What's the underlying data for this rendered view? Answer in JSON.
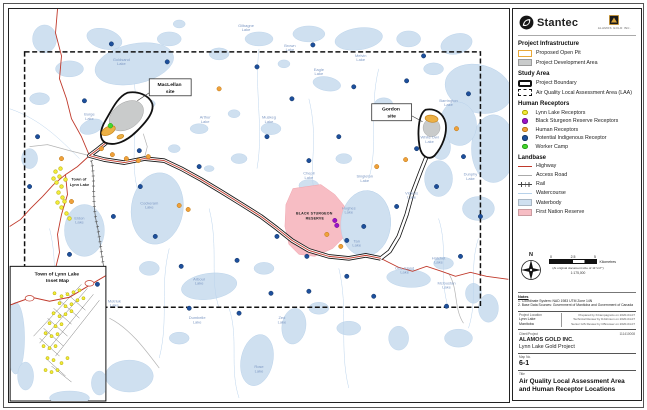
{
  "branding": {
    "stantec": "Stantec",
    "client_logo_caption": "Alamos Gold Inc."
  },
  "legend": {
    "sections": [
      {
        "title": "Project Infrastructure",
        "items": [
          {
            "label": "Proposed Open Pit",
            "swatch": "open-pit"
          },
          {
            "label": "Project Development Area",
            "swatch": "dev-area"
          }
        ]
      },
      {
        "title": "Study Area",
        "items": [
          {
            "label": "Project Boundary",
            "swatch": "project-boundary"
          },
          {
            "label": "Air Quality Local Assessment Area (LAA)",
            "swatch": "laa"
          }
        ]
      },
      {
        "title": "Human Receptors",
        "items": [
          {
            "label": "Lynn Lake Receptors",
            "swatch": "dot",
            "color": "#f1ec3a",
            "stroke": "#b5a900"
          },
          {
            "label": "Black Sturgeon Reserve Receptors",
            "swatch": "dot",
            "color": "#9b13c8",
            "stroke": "#6d0d8e"
          },
          {
            "label": "Human Receptors",
            "swatch": "dot",
            "color": "#f0a13a",
            "stroke": "#b97413"
          },
          {
            "label": "Potential Indigenous Receptor",
            "swatch": "dot",
            "color": "#1d4f9c",
            "stroke": "#123463"
          },
          {
            "label": "Worker Camp",
            "swatch": "dot",
            "color": "#45d62e",
            "stroke": "#249e15"
          }
        ]
      },
      {
        "title": "Landbase",
        "items": [
          {
            "label": "Highway",
            "swatch": "line",
            "color": "#c0392b"
          },
          {
            "label": "Access Road",
            "swatch": "line",
            "color": "#aaaaaa"
          },
          {
            "label": "Rail",
            "swatch": "rail"
          },
          {
            "label": "Watercourse",
            "swatch": "watercourse",
            "color": "#b8d2ea"
          },
          {
            "label": "Waterbody",
            "swatch": "fill",
            "color": "#cfe0f0"
          },
          {
            "label": "First Nation Reserve",
            "swatch": "fill",
            "color": "#f7bdc4"
          }
        ]
      }
    ]
  },
  "compass": {
    "label": "N"
  },
  "scalebar": {
    "ticks": [
      "0",
      "2.5",
      "5"
    ],
    "unit": "Kilometres",
    "note": "(At original document size of 11\"x17\")",
    "ratio": "1:175,000"
  },
  "notes": {
    "heading": "Notes",
    "lines": [
      "1. Coordinate System: NAD 1983 UTM Zone 14N",
      "2. Base Data Sources: Government of Manitoba and Government of Canada"
    ]
  },
  "title_block": {
    "project_location_label": "Project Location",
    "project_location": [
      "Lynn Lake",
      "Manitoba"
    ],
    "credits": [
      "Prepared by KCampagnolo on 2020-04-07",
      "Technical Review by DJohnson on 2020-04-07",
      "Senior GIS Review by CBrouwer on 2020-04-07"
    ],
    "client_project_label": "Client/Project",
    "project_number": "111410008",
    "client": "ALAMOS GOLD INC.",
    "project": "Lynn Lake Gold Project",
    "map_no_label": "Map No.",
    "map_no": "6-1",
    "title_label": "Title",
    "title": "Air Quality Local Assessment Area and Human Receptor Locations"
  },
  "map": {
    "labels": {
      "maclellan": {
        "line1": "MacLellan",
        "line2": "site"
      },
      "gordon": {
        "line1": "Gordon",
        "line2": "site"
      },
      "town": {
        "line1": "Town of",
        "line2": "Lynn Lake"
      },
      "reserve": {
        "line1": "BLACK STURGEON",
        "line2": "RESERVE"
      },
      "inset_title": {
        "line1": "Town of Lynn Lake",
        "line2": "Inset Map"
      }
    },
    "lakes": [
      {
        "name": "Goldsand Lake",
        "x": 112,
        "y": 52
      },
      {
        "name": "Gilbagne Lake",
        "x": 237,
        "y": 18
      },
      {
        "name": "Brown Lake",
        "x": 281,
        "y": 38
      },
      {
        "name": "Eagle Lake",
        "x": 310,
        "y": 62
      },
      {
        "name": "Melvin Lake",
        "x": 352,
        "y": 48
      },
      {
        "name": "Burge Lake",
        "x": 80,
        "y": 107
      },
      {
        "name": "Arthur Lake",
        "x": 196,
        "y": 110
      },
      {
        "name": "Muskeg Lake",
        "x": 260,
        "y": 110
      },
      {
        "name": "Barrington Lake",
        "x": 440,
        "y": 93
      },
      {
        "name": "White Owl Lake",
        "x": 421,
        "y": 130
      },
      {
        "name": "Dunphy Lake",
        "x": 462,
        "y": 167
      },
      {
        "name": "Singleton Lake",
        "x": 356,
        "y": 169
      },
      {
        "name": "Vickers Lake",
        "x": 403,
        "y": 186
      },
      {
        "name": "Cockeram Lake",
        "x": 140,
        "y": 196
      },
      {
        "name": "Eldon Lake",
        "x": 70,
        "y": 211
      },
      {
        "name": "Chepil Lake",
        "x": 300,
        "y": 166
      },
      {
        "name": "Hughes Lake",
        "x": 340,
        "y": 201
      },
      {
        "name": "Tan Lake",
        "x": 348,
        "y": 234
      },
      {
        "name": "One Island Lake",
        "x": 396,
        "y": 261
      },
      {
        "name": "Hatchet Lake",
        "x": 430,
        "y": 251
      },
      {
        "name": "McGustan Lake",
        "x": 438,
        "y": 276
      },
      {
        "name": "Arbour Lake",
        "x": 190,
        "y": 272
      },
      {
        "name": "Motriuk Lake",
        "x": 105,
        "y": 294
      },
      {
        "name": "Dumbelle Lake",
        "x": 188,
        "y": 311
      },
      {
        "name": "Zed Lake",
        "x": 273,
        "y": 311
      },
      {
        "name": "Rose Lake",
        "x": 250,
        "y": 360
      }
    ],
    "receptors": [
      {
        "name": "lynn-lake-receptor",
        "color": "#f1ec3a",
        "stroke": "#b5a900",
        "r": 1.9,
        "points": [
          [
            46,
            163
          ],
          [
            50,
            168
          ],
          [
            47,
            174
          ],
          [
            52,
            178
          ],
          [
            49,
            184
          ],
          [
            53,
            189
          ],
          [
            48,
            194
          ],
          [
            52,
            199
          ],
          [
            56,
            171
          ],
          [
            55,
            193
          ],
          [
            44,
            170
          ],
          [
            51,
            160
          ],
          [
            57,
            205
          ],
          [
            60,
            210
          ]
        ]
      },
      {
        "name": "black-sturgeon-receptor",
        "color": "#9b13c8",
        "stroke": "#6d0d8e",
        "r": 2.2,
        "points": [
          [
            326,
            212
          ],
          [
            328,
            217
          ]
        ]
      },
      {
        "name": "human-receptor",
        "color": "#f0a13a",
        "stroke": "#b97413",
        "r": 2.2,
        "points": [
          [
            210,
            80
          ],
          [
            92,
            140
          ],
          [
            103,
            146
          ],
          [
            117,
            150
          ],
          [
            129,
            152
          ],
          [
            139,
            148
          ],
          [
            62,
            193
          ],
          [
            170,
            197
          ],
          [
            179,
            201
          ],
          [
            318,
            226
          ],
          [
            368,
            158
          ],
          [
            397,
            151
          ],
          [
            448,
            120
          ],
          [
            332,
            238
          ],
          [
            52,
            150
          ]
        ]
      },
      {
        "name": "potential-indigenous-receptor",
        "color": "#1d4f9c",
        "stroke": "#123463",
        "r": 2.2,
        "points": [
          [
            75,
            92
          ],
          [
            102,
            35
          ],
          [
            158,
            53
          ],
          [
            248,
            58
          ],
          [
            304,
            36
          ],
          [
            283,
            90
          ],
          [
            345,
            78
          ],
          [
            398,
            72
          ],
          [
            415,
            47
          ],
          [
            460,
            85
          ],
          [
            455,
            148
          ],
          [
            408,
            140
          ],
          [
            330,
            128
          ],
          [
            300,
            152
          ],
          [
            258,
            128
          ],
          [
            190,
            158
          ],
          [
            131,
            178
          ],
          [
            104,
            208
          ],
          [
            146,
            228
          ],
          [
            172,
            258
          ],
          [
            228,
            252
          ],
          [
            268,
            228
          ],
          [
            298,
            248
          ],
          [
            338,
            232
          ],
          [
            355,
            218
          ],
          [
            388,
            198
          ],
          [
            428,
            178
          ],
          [
            262,
            285
          ],
          [
            300,
            283
          ],
          [
            338,
            268
          ],
          [
            365,
            288
          ],
          [
            60,
            246
          ],
          [
            88,
            276
          ],
          [
            28,
            128
          ],
          [
            20,
            178
          ],
          [
            452,
            248
          ],
          [
            472,
            208
          ],
          [
            438,
            298
          ],
          [
            230,
            305
          ],
          [
            180,
            300
          ],
          [
            130,
            142
          ]
        ]
      },
      {
        "name": "worker-camp",
        "color": "#45d62e",
        "stroke": "#249e15",
        "r": 2.4,
        "points": [
          [
            101,
            117
          ]
        ]
      },
      {
        "name": "lynn-lake-receptor-inset",
        "color": "#f1ec3a",
        "stroke": "#b5a900",
        "r": 1.6,
        "points": [
          [
            45,
            285
          ],
          [
            52,
            288
          ],
          [
            58,
            286
          ],
          [
            64,
            284
          ],
          [
            70,
            282
          ],
          [
            50,
            295
          ],
          [
            56,
            298
          ],
          [
            62,
            296
          ],
          [
            68,
            292
          ],
          [
            74,
            290
          ],
          [
            44,
            305
          ],
          [
            50,
            308
          ],
          [
            56,
            306
          ],
          [
            62,
            303
          ],
          [
            40,
            315
          ],
          [
            46,
            318
          ],
          [
            52,
            316
          ],
          [
            36,
            325
          ],
          [
            42,
            328
          ],
          [
            48,
            326
          ],
          [
            34,
            338
          ],
          [
            40,
            340
          ],
          [
            46,
            338
          ],
          [
            38,
            350
          ],
          [
            44,
            352
          ],
          [
            36,
            362
          ],
          [
            42,
            364
          ],
          [
            48,
            362
          ],
          [
            52,
            355
          ],
          [
            58,
            350
          ]
        ]
      }
    ]
  }
}
